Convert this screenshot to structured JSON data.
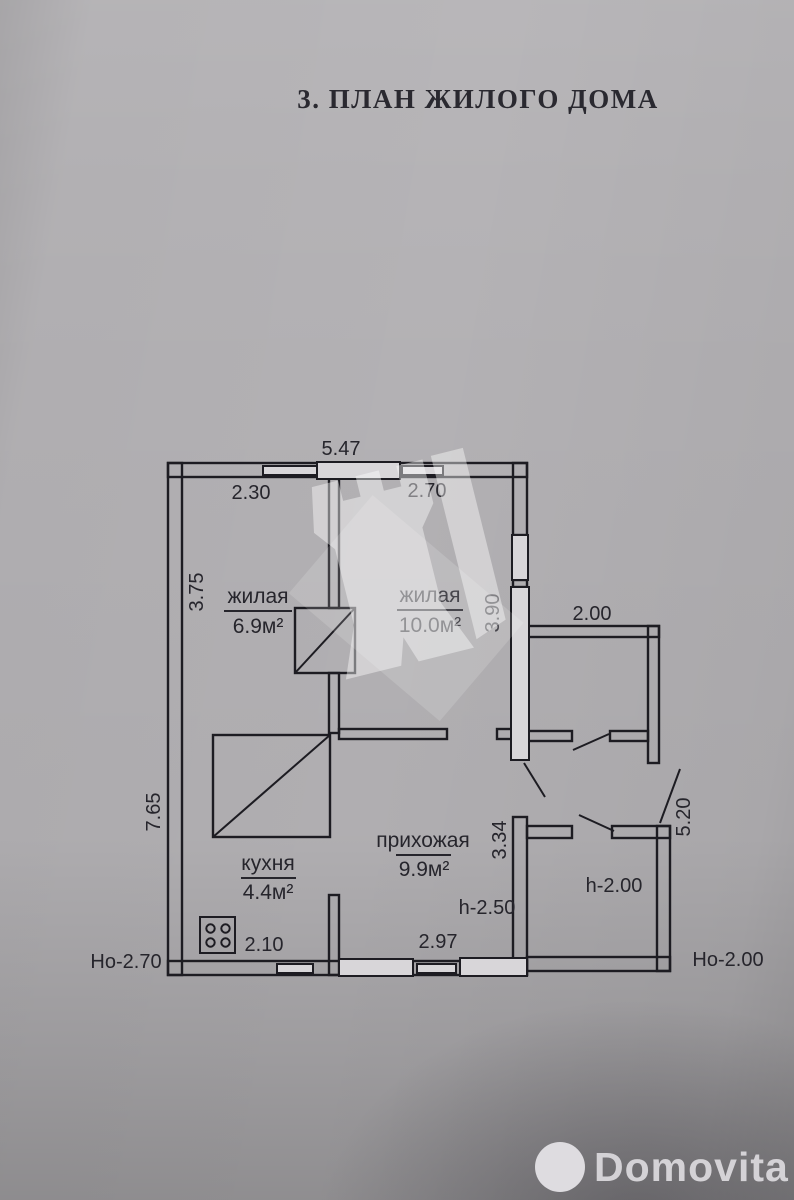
{
  "title": "3. ПЛАН ЖИЛОГО ДОМА",
  "plan": {
    "rooms": [
      {
        "name": "жилая",
        "area": "6.9м²"
      },
      {
        "name": "жилая",
        "area": "10.0м²"
      },
      {
        "name": "кухня",
        "area": "4.4м²"
      },
      {
        "name": "прихожая",
        "area": "9.9м²"
      }
    ],
    "dimensions": {
      "house_width": "5.47",
      "living1_width": "2.30",
      "living2_width": "2.70",
      "living1_depth": "3.75",
      "house_depth": "7.65",
      "living2_depth": "3.90",
      "porch_width": "2.00",
      "hall_depth": "3.34",
      "annex_right_depth": "5.20",
      "kitchen_width": "2.10",
      "hall_width": "2.97"
    },
    "ceiling_heights": {
      "hall": "h-2.50",
      "porch": "h-2.00",
      "house_outer": "Но-2.70",
      "annex_outer": "Но-2.00"
    }
  },
  "branding": {
    "name": "Domovita"
  }
}
